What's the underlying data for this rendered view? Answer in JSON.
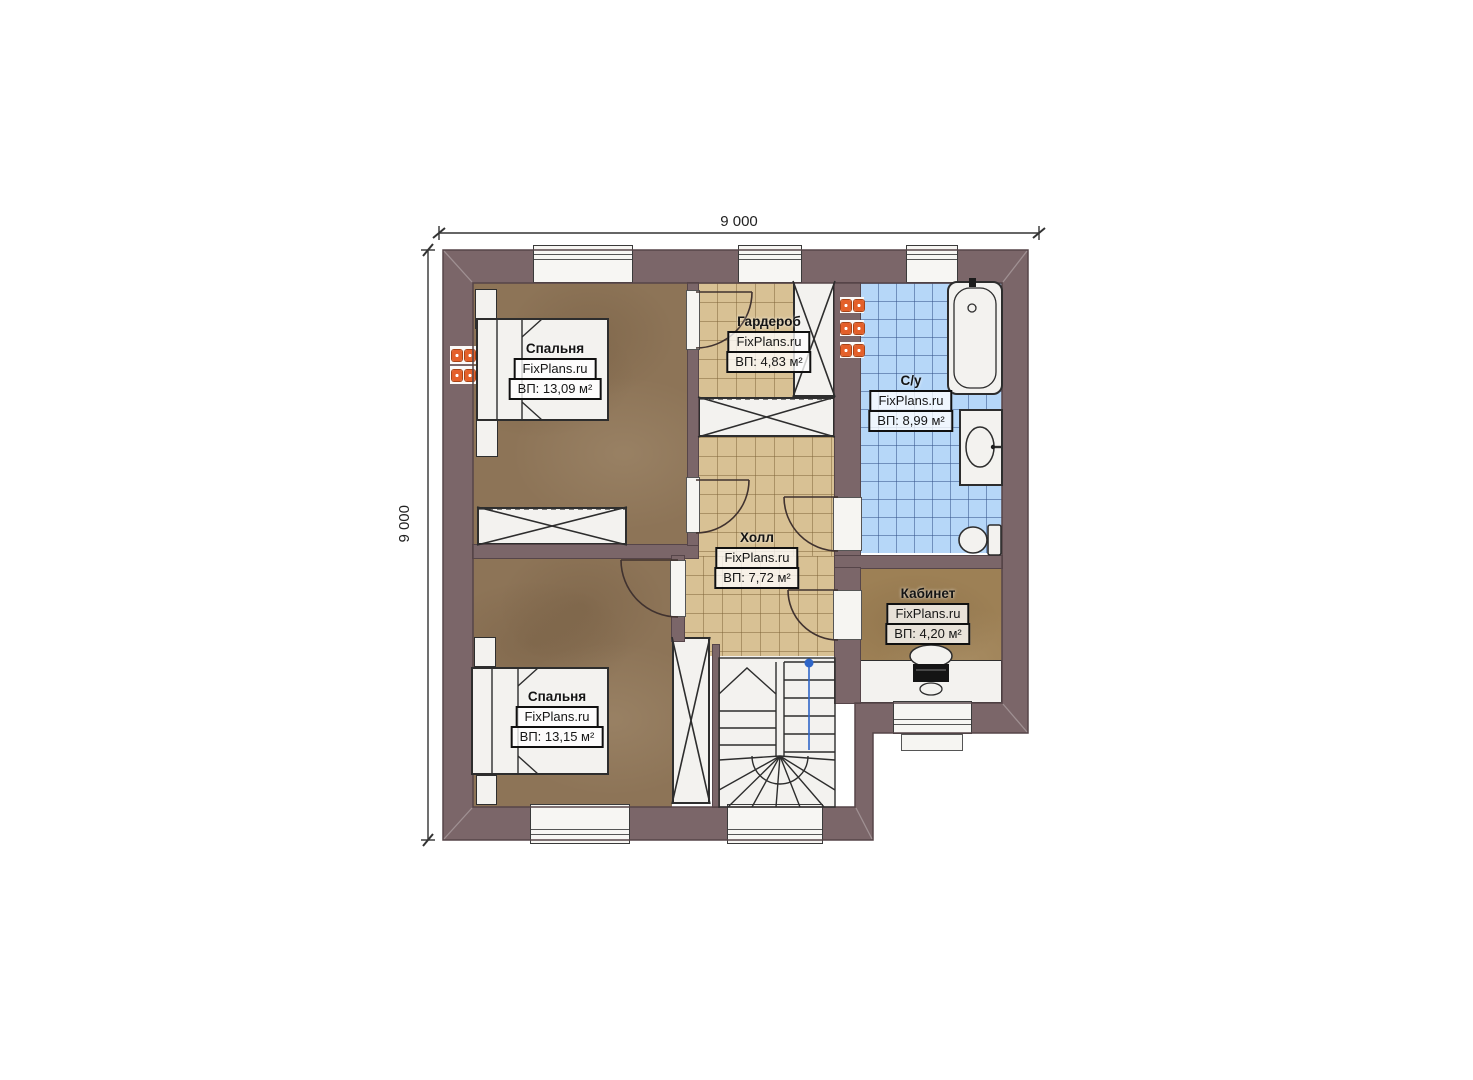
{
  "plan": {
    "type": "floor-plan",
    "watermark": "FixPlans.ru"
  },
  "dimensions": {
    "width_label": "9 000",
    "height_label": "9 000"
  },
  "rooms": [
    {
      "id": "bedroom-1",
      "name": "Спальня",
      "watermark": "FixPlans.ru",
      "area_label": "ВП: 13,09 м²"
    },
    {
      "id": "wardrobe",
      "name": "Гардероб",
      "watermark": "FixPlans.ru",
      "area_label": "ВП: 4,83 м²"
    },
    {
      "id": "bathroom",
      "name": "С/у",
      "watermark": "FixPlans.ru",
      "area_label": "ВП: 8,99 м²"
    },
    {
      "id": "hall",
      "name": "Холл",
      "watermark": "FixPlans.ru",
      "area_label": "ВП: 7,72 м²"
    },
    {
      "id": "office",
      "name": "Кабинет",
      "watermark": "FixPlans.ru",
      "area_label": "ВП: 4,20 м²"
    },
    {
      "id": "bedroom-2",
      "name": "Спальня",
      "watermark": "FixPlans.ru",
      "area_label": "ВП: 13,15 м²"
    }
  ],
  "colors": {
    "wall": "#7b6669",
    "bedroom_floor": "#8d7457",
    "office_floor": "#9d8055",
    "hall_tile": "#d8c194",
    "bathroom_tile": "#b6d7f8",
    "furniture": "#f3f2ef",
    "radiator": "#e4602a",
    "stair_marker": "#2f66c8"
  }
}
